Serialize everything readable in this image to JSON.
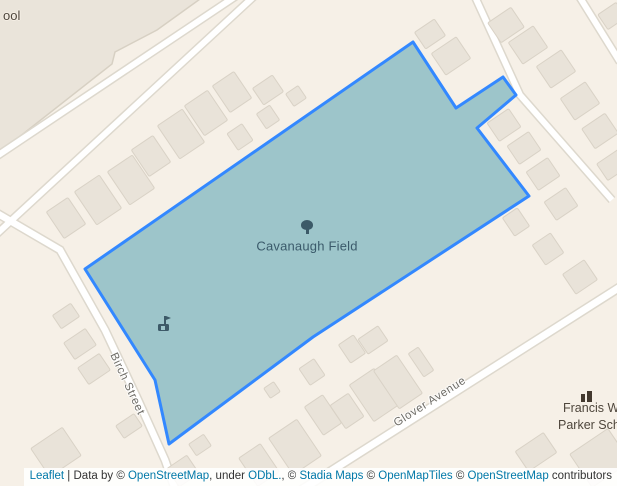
{
  "map": {
    "field": {
      "label": "Cavanaugh Field",
      "vertices": [
        [
          413,
          42
        ],
        [
          456,
          108
        ],
        [
          503,
          77
        ],
        [
          516,
          95
        ],
        [
          477,
          128
        ],
        [
          529,
          196
        ],
        [
          313,
          337
        ],
        [
          169,
          444
        ],
        [
          155,
          380
        ],
        [
          85,
          269
        ]
      ],
      "fill": "#9dc5ca",
      "stroke": "#3388ff",
      "stroke_width": 3
    },
    "streets": {
      "birch": "Birch Street",
      "glover": "Glover Avenue"
    },
    "pois": {
      "school_cutoff": "ool",
      "parker_line1": "Francis W",
      "parker_line2": "Parker Sch"
    },
    "icons": {
      "field_marker": "tree-icon",
      "in_field": "playground-icon",
      "parker": "school-icon"
    },
    "school_grounds": [
      [
        -6,
        -6
      ],
      [
        207,
        -6
      ],
      [
        157,
        30
      ],
      [
        115,
        52
      ],
      [
        112,
        64
      ],
      [
        0,
        152
      ],
      [
        -6,
        152
      ]
    ],
    "roads": [
      {
        "id": "road-a",
        "w": 6,
        "points": [
          [
            -12,
            162
          ],
          [
            248,
            -12
          ]
        ]
      },
      {
        "id": "road-b",
        "w": 6,
        "points": [
          [
            -12,
            242
          ],
          [
            250,
            0
          ],
          [
            263,
            -12
          ]
        ]
      },
      {
        "id": "birch-street",
        "w": 6.5,
        "points": [
          [
            -5,
            212
          ],
          [
            60,
            250
          ],
          [
            105,
            330
          ],
          [
            138,
            400
          ],
          [
            165,
            460
          ],
          [
            176,
            492
          ]
        ]
      },
      {
        "id": "glover-avenue",
        "w": 7,
        "points": [
          [
            298,
            492
          ],
          [
            620,
            287
          ]
        ]
      },
      {
        "id": "road-c",
        "w": 6,
        "points": [
          [
            471,
            -12
          ],
          [
            520,
            95
          ],
          [
            612,
            200
          ]
        ]
      },
      {
        "id": "road-d",
        "w": 6,
        "points": [
          [
            574,
            -12
          ],
          [
            620,
            62
          ]
        ]
      }
    ],
    "buildings": [
      [
        66,
        218,
        26,
        32,
        -34
      ],
      [
        98,
        200,
        30,
        40,
        -34
      ],
      [
        131,
        180,
        30,
        40,
        -34
      ],
      [
        151,
        156,
        26,
        32,
        -34
      ],
      [
        181,
        134,
        30,
        40,
        -34
      ],
      [
        206,
        113,
        28,
        36,
        -34
      ],
      [
        232,
        92,
        26,
        32,
        -34
      ],
      [
        240,
        137,
        18,
        20,
        -34
      ],
      [
        268,
        90,
        24,
        20,
        -34
      ],
      [
        268,
        117,
        16,
        18,
        -34
      ],
      [
        296,
        96,
        15,
        15,
        -34
      ],
      [
        430,
        34,
        20,
        24,
        56
      ],
      [
        451,
        56,
        26,
        30,
        56
      ],
      [
        612,
        16,
        18,
        22,
        56
      ],
      [
        506,
        25,
        24,
        28,
        56
      ],
      [
        528,
        45,
        26,
        30,
        56
      ],
      [
        556,
        69,
        26,
        30,
        56
      ],
      [
        580,
        101,
        26,
        30,
        56
      ],
      [
        600,
        131,
        24,
        28,
        56
      ],
      [
        613,
        165,
        20,
        26,
        56
      ],
      [
        504,
        125,
        22,
        26,
        56
      ],
      [
        524,
        148,
        22,
        26,
        56
      ],
      [
        543,
        174,
        22,
        26,
        56
      ],
      [
        561,
        204,
        22,
        26,
        56
      ],
      [
        516,
        222,
        22,
        18,
        56
      ],
      [
        548,
        249,
        24,
        22,
        56
      ],
      [
        580,
        277,
        24,
        26,
        56
      ],
      [
        312,
        372,
        18,
        20,
        -34
      ],
      [
        272,
        390,
        12,
        12,
        -34
      ],
      [
        352,
        349,
        18,
        22,
        -34
      ],
      [
        373,
        340,
        24,
        18,
        -34
      ],
      [
        374,
        395,
        30,
        44,
        -34
      ],
      [
        398,
        382,
        28,
        46,
        -34
      ],
      [
        421,
        362,
        12,
        28,
        -34
      ],
      [
        323,
        415,
        22,
        34,
        -34
      ],
      [
        347,
        411,
        22,
        28,
        -34
      ],
      [
        259,
        465,
        26,
        34,
        -34
      ],
      [
        295,
        447,
        34,
        44,
        -34
      ],
      [
        200,
        445,
        18,
        14,
        -34
      ],
      [
        183,
        471,
        24,
        22,
        -34
      ],
      [
        536,
        452,
        34,
        24,
        -34
      ],
      [
        600,
        458,
        46,
        40,
        -34
      ],
      [
        66,
        316,
        16,
        22,
        56
      ],
      [
        80,
        344,
        20,
        26,
        56
      ],
      [
        94,
        369,
        20,
        26,
        56
      ],
      [
        56,
        452,
        34,
        38,
        56
      ],
      [
        129,
        426,
        15,
        22,
        56
      ]
    ],
    "colors": {
      "background": "#f6f0e7",
      "building_fill": "#e9e3d9",
      "building_stroke": "#d9d2c6",
      "grounds_fill": "#eae4da",
      "grounds_stroke": "#d7d0c3",
      "road_fill": "#ffffff",
      "road_casing": "#ddd8cd",
      "field_fill": "#9dc5ca",
      "field_stroke": "#3388ff",
      "street_label": "#6e6c66",
      "park_label": "#3b5a6b",
      "school_label": "#4e463c",
      "attribution_link": "#0078a8",
      "attribution_text": "#333333"
    }
  },
  "attribution": {
    "parts": [
      {
        "text": "Leaflet",
        "link": true
      },
      {
        "text": " | Data by © ",
        "link": false
      },
      {
        "text": "OpenStreetMap",
        "link": true
      },
      {
        "text": ", under ",
        "link": false
      },
      {
        "text": "ODbL.",
        "link": true
      },
      {
        "text": ", © ",
        "link": false
      },
      {
        "text": "Stadia Maps",
        "link": true
      },
      {
        "text": " © ",
        "link": false
      },
      {
        "text": "OpenMapTiles",
        "link": true
      },
      {
        "text": " © ",
        "link": false
      },
      {
        "text": "OpenStreetMap",
        "link": true
      },
      {
        "text": " contributors",
        "link": false
      }
    ]
  }
}
